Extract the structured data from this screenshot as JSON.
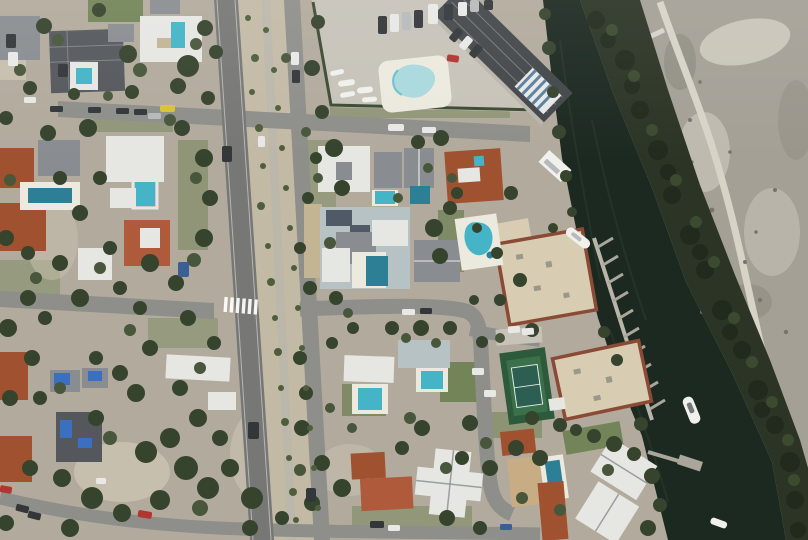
{
  "scene": {
    "title": "Aerial drone photograph of a coastal residential neighborhood",
    "description": "Top-down aerial view of a barrier-island neighborhood. A divided two-lane road with a sandy, shrub-filled median and walking path runs vertically through the frame. Single-family homes with white, gray and terracotta roofs and turquoise backyard pools fill the left blocks; several roofs lower-left are covered with blue hurricane tarps. Top-center is a marina parking lot with a kidney-shaped pool, stored boats, rows of parked cars and a long dark-roofed building at the water's edge. Cream-colored condominium buildings with brown trim and rows of finger docks line a dark green canal on the right; a white boat is moored at the seawall. Beyond the canal a dense mangrove band borders a bare sandy spoil island crossed by a light dirt track. A tennis court, a crosswalk on the main road, and yellow, red and blue cars are visible.",
    "features": [
      "divided-main-road",
      "median-walking-path",
      "cross-streets",
      "crosswalk",
      "residential-houses",
      "backyard-pools",
      "blue-tarp-damaged-roofs",
      "marina-parking-lot",
      "kidney-pool",
      "stored-boats",
      "parked-cars",
      "dark-waterfront-building",
      "striped-awning-dock",
      "cream-condo-buildings",
      "finger-docks",
      "moored-boats",
      "canal",
      "mangrove-band",
      "sand-spoil-island",
      "dirt-track",
      "tennis-court",
      "lawns",
      "trees"
    ]
  },
  "colors": {
    "land": "#b2ab9d",
    "lawn": "#6c8051",
    "tree_dark": "#36432d",
    "tree_mid": "#48563b",
    "shrub": "#4e5e3a",
    "water": "#1c2921",
    "water_streak": "#2a382d",
    "mangrove_band": "#2b3425",
    "mangrove_dark": "#222a1d",
    "mangrove_mid": "#3c4a30",
    "sand": "#a5a096",
    "sand_light": "#c9c5b9",
    "sand_dark": "#8d8a80",
    "track": "#d7d3c7",
    "debris": "#77746b",
    "road": "#8e8e8a",
    "road_main": "#777875",
    "path": "#bcb7ab",
    "median": "#c3baa6",
    "lot": "#c7c3b9",
    "hedge": "#3c4a33",
    "dirt": "#c3b493",
    "sandy_patch": "#c7bfae",
    "roof_white": "#e6e7e3",
    "roof_gray": "#898d91",
    "roof_gray_dark": "#54585c",
    "roof_charcoal": "#43474a",
    "roof_blue_gray": "#b7c2c4",
    "roof_terracotta": "#a0512f",
    "roof_terracotta_bright": "#b05a3c",
    "roof_tan": "#c8ac84",
    "roof_cream": "#d8cdb2",
    "condo_trim": "#8a4a35",
    "pool": "#44b4c6",
    "pool_dark": "#2c7f95",
    "pool_pale": "#a9d9de",
    "pool_deck": "#eceade",
    "tarp_blue": "#3b6fc0",
    "car_dark": "#33373a",
    "car_white": "#e8e8e6",
    "car_silver": "#b7babc",
    "car_yellow": "#d8c23a",
    "car_red": "#b13530",
    "car_blue": "#3a5f93",
    "tennis_outer": "#2e5a3c",
    "tennis_inner": "#3a714a",
    "tennis_center": "#2d5e52",
    "white_line": "#ffffff",
    "dock": "#aaa69b",
    "seawall": "#b9b5aa",
    "boat": "#f0f0ec",
    "awning_stripe": "#5b7f9e",
    "solar": "#4f5a66"
  }
}
